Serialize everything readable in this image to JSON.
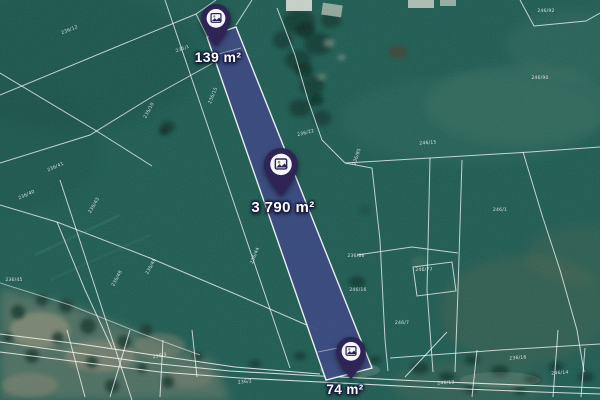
{
  "map": {
    "kind": "satellite-cadastral-view",
    "colors": {
      "field_green": "#1C5A50",
      "highlight_parcel_fill": "#3E4B82",
      "boundary_line": "#FFFFFF",
      "pin_body": "#2E2556"
    },
    "markers": [
      {
        "name": "parcel-marker-top",
        "area": "139 m²"
      },
      {
        "name": "parcel-marker-middle",
        "area": "3 790 m²"
      },
      {
        "name": "parcel-marker-bottom",
        "area": "74 m²"
      }
    ],
    "parcel_labels": [
      {
        "text": "236/12",
        "x": 70,
        "y": 31,
        "rot": -22
      },
      {
        "text": "235/1",
        "x": 183,
        "y": 50,
        "rot": -20
      },
      {
        "text": "236/10",
        "x": 150,
        "y": 111,
        "rot": -62
      },
      {
        "text": "236/41",
        "x": 56,
        "y": 168,
        "rot": -24
      },
      {
        "text": "236/40",
        "x": 27,
        "y": 196,
        "rot": -24
      },
      {
        "text": "236/43",
        "x": 95,
        "y": 206,
        "rot": -60
      },
      {
        "text": "236/48",
        "x": 118,
        "y": 279,
        "rot": -62
      },
      {
        "text": "236/46",
        "x": 152,
        "y": 267,
        "rot": -62
      },
      {
        "text": "236/45",
        "x": 14,
        "y": 281,
        "rot": 0
      },
      {
        "text": "236/15",
        "x": 214,
        "y": 96,
        "rot": -68
      },
      {
        "text": "236/44",
        "x": 256,
        "y": 256,
        "rot": -68
      },
      {
        "text": "236/22",
        "x": 306,
        "y": 134,
        "rot": -14
      },
      {
        "text": "236/85",
        "x": 358,
        "y": 157,
        "rot": -72
      },
      {
        "text": "246/90",
        "x": 540,
        "y": 79,
        "rot": 0
      },
      {
        "text": "246/92",
        "x": 546,
        "y": 12,
        "rot": 0
      },
      {
        "text": "246/15",
        "x": 428,
        "y": 144,
        "rot": -4
      },
      {
        "text": "246/1",
        "x": 500,
        "y": 211,
        "rot": 0
      },
      {
        "text": "236/86",
        "x": 356,
        "y": 257,
        "rot": 0
      },
      {
        "text": "246/16",
        "x": 358,
        "y": 291,
        "rot": 0
      },
      {
        "text": "246/77",
        "x": 424,
        "y": 271,
        "rot": 0
      },
      {
        "text": "246/7",
        "x": 402,
        "y": 324,
        "rot": 0
      },
      {
        "text": "236/16",
        "x": 518,
        "y": 359,
        "rot": -4
      },
      {
        "text": "246/14",
        "x": 560,
        "y": 374,
        "rot": -4
      },
      {
        "text": "246/13",
        "x": 446,
        "y": 384,
        "rot": -4
      },
      {
        "text": "236/2",
        "x": 245,
        "y": 383,
        "rot": -6
      },
      {
        "text": "236/3",
        "x": 160,
        "y": 357,
        "rot": -10
      }
    ]
  }
}
